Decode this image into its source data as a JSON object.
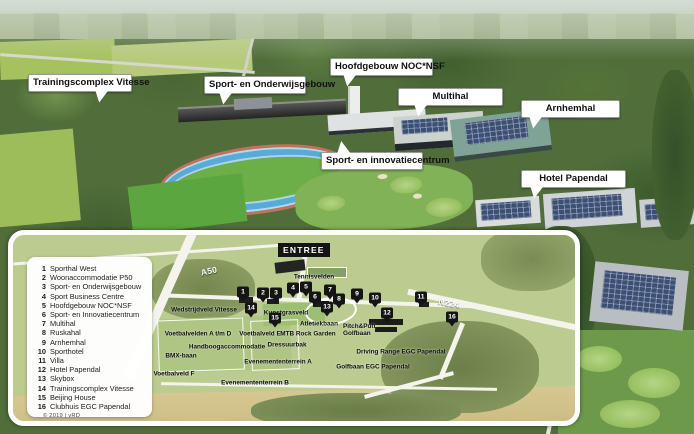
{
  "callouts": [
    {
      "label": "Trainingscomplex Vitesse"
    },
    {
      "label": "Sport- en Onderwijsgebouw"
    },
    {
      "label": "Hoofdgebouw NOC*NSF"
    },
    {
      "label": "Multihal"
    },
    {
      "label": "Arnhemhal"
    },
    {
      "label": "Sport- en innovatiecentrum"
    },
    {
      "label": "Hotel Papendal"
    }
  ],
  "map": {
    "entree_label": "ENTREE",
    "copyright": "© 2019 | vRD",
    "legend": [
      {
        "n": "1",
        "label": "Sporthal West"
      },
      {
        "n": "2",
        "label": "Woonaccommodatie P50"
      },
      {
        "n": "3",
        "label": "Sport- en Onderwijsgebouw"
      },
      {
        "n": "4",
        "label": "Sport Business Centre"
      },
      {
        "n": "5",
        "label": "Hoofdgebouw NOC*NSF"
      },
      {
        "n": "6",
        "label": "Sport- en Innovatiecentrum"
      },
      {
        "n": "7",
        "label": "Multihal"
      },
      {
        "n": "8",
        "label": "Ruskahal"
      },
      {
        "n": "9",
        "label": "Arnhemhal"
      },
      {
        "n": "10",
        "label": "Sporthotel"
      },
      {
        "n": "11",
        "label": "Villa"
      },
      {
        "n": "12",
        "label": "Hotel Papendal"
      },
      {
        "n": "13",
        "label": "Skybox"
      },
      {
        "n": "14",
        "label": "Trainingscomplex Vitesse"
      },
      {
        "n": "15",
        "label": "Beijing House"
      },
      {
        "n": "16",
        "label": "Clubhuis EGC Papendal"
      }
    ],
    "road_labels": [
      {
        "text": "A50",
        "x": 196,
        "y": 36,
        "rot": -12
      },
      {
        "text": "N224",
        "x": 436,
        "y": 68,
        "rot": 11
      }
    ],
    "labels": [
      {
        "text": "Tennisvelden",
        "x": 301,
        "y": 42
      },
      {
        "text": "Wedstrijdveld Vitesse",
        "x": 191,
        "y": 75
      },
      {
        "text": "Kunstgrasveld",
        "x": 273,
        "y": 78
      },
      {
        "text": "Atletiekbaan",
        "x": 306,
        "y": 89
      },
      {
        "text": "Voetbalvelden A t/m D",
        "x": 185,
        "y": 99
      },
      {
        "text": "Voetbalveld E",
        "x": 247,
        "y": 99
      },
      {
        "text": "MTB Rock Garden",
        "x": 295,
        "y": 99
      },
      {
        "text": "Dressuurbak",
        "x": 274,
        "y": 110
      },
      {
        "text": "Handboogaccommodatie",
        "x": 214,
        "y": 112
      },
      {
        "text": "BMX-baan",
        "x": 168,
        "y": 121
      },
      {
        "text": "Evenemententerrein A",
        "x": 265,
        "y": 127
      },
      {
        "text": "Voetbalveld F",
        "x": 161,
        "y": 139
      },
      {
        "text": "Evenemententerrein B",
        "x": 242,
        "y": 148
      },
      {
        "text": "Pitch&Putt Golfbaan",
        "x": 352,
        "y": 96,
        "wrap": true
      },
      {
        "text": "Driving Range EGC Papendal",
        "x": 388,
        "y": 117
      },
      {
        "text": "Golfbaan EGC Papendal",
        "x": 360,
        "y": 132
      }
    ],
    "markers": [
      {
        "n": "1",
        "x": 230,
        "y": 57
      },
      {
        "n": "2",
        "x": 250,
        "y": 58
      },
      {
        "n": "3",
        "x": 263,
        "y": 58
      },
      {
        "n": "4",
        "x": 280,
        "y": 53
      },
      {
        "n": "5",
        "x": 293,
        "y": 52
      },
      {
        "n": "6",
        "x": 302,
        "y": 62
      },
      {
        "n": "7",
        "x": 317,
        "y": 55
      },
      {
        "n": "8",
        "x": 326,
        "y": 64
      },
      {
        "n": "9",
        "x": 344,
        "y": 59
      },
      {
        "n": "10",
        "x": 362,
        "y": 63
      },
      {
        "n": "11",
        "x": 408,
        "y": 62
      },
      {
        "n": "12",
        "x": 374,
        "y": 78
      },
      {
        "n": "13",
        "x": 314,
        "y": 72
      },
      {
        "n": "14",
        "x": 238,
        "y": 73
      },
      {
        "n": "15",
        "x": 262,
        "y": 83
      },
      {
        "n": "16",
        "x": 439,
        "y": 82
      }
    ]
  },
  "colors": {
    "callout_bg": "#ffffff",
    "marker_bg": "#141414",
    "map_base": "#bccb90",
    "road_white": "#f4f3ec",
    "solar_panel": "#3c4f75"
  }
}
